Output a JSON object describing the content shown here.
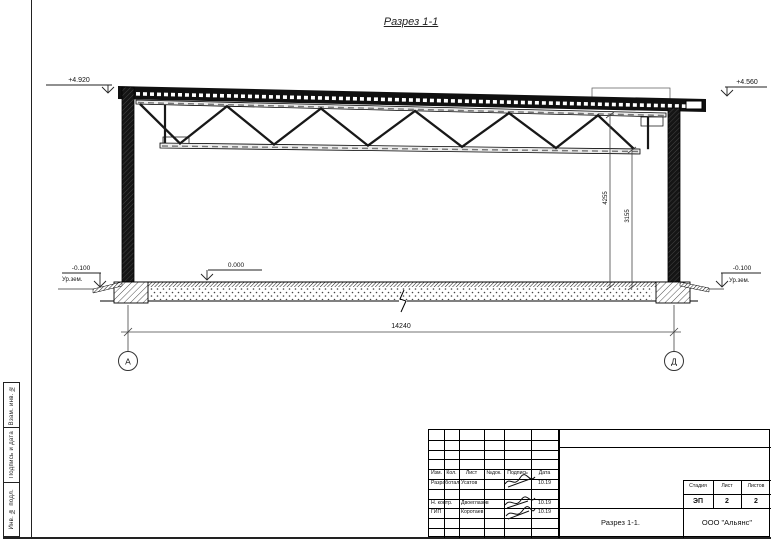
{
  "page": {
    "title": "Разрез 1-1"
  },
  "drawing": {
    "elevations": {
      "left_top": "+4.920",
      "right_top": "+4.560",
      "floor": "0.000",
      "ground_left_value": "-0.100",
      "ground_left_label": "Ур.зем.",
      "ground_right_value": "-0.100",
      "ground_right_label": "Ур.зем."
    },
    "dimensions": {
      "truss_top": "4255",
      "truss_bottom": "3155",
      "span": "14240"
    },
    "axes": {
      "left": "А",
      "right": "Д"
    }
  },
  "sidebar": {
    "cells": [
      "Взам. инв. №",
      "Подпись и дата",
      "Инв. № подл."
    ]
  },
  "title_block": {
    "header": [
      "Изм.",
      "Кол.",
      "Лист",
      "№док.",
      "Подпись",
      "Дата"
    ],
    "rows": [
      {
        "role": "Разработал",
        "name": "Усатов",
        "date": "10.19"
      },
      {
        "role": "Н. контр.",
        "name": "Двоеглазов",
        "date": "10.19"
      },
      {
        "role": "ГИП",
        "name": "Коротаев",
        "date": "10.19"
      }
    ],
    "stage_header": [
      "Стадия",
      "Лист",
      "Листов"
    ],
    "stage_values": [
      "ЭП",
      "2",
      "2"
    ],
    "doc_title": "Разрез 1-1.",
    "company": "ООО \"Альянс\""
  }
}
